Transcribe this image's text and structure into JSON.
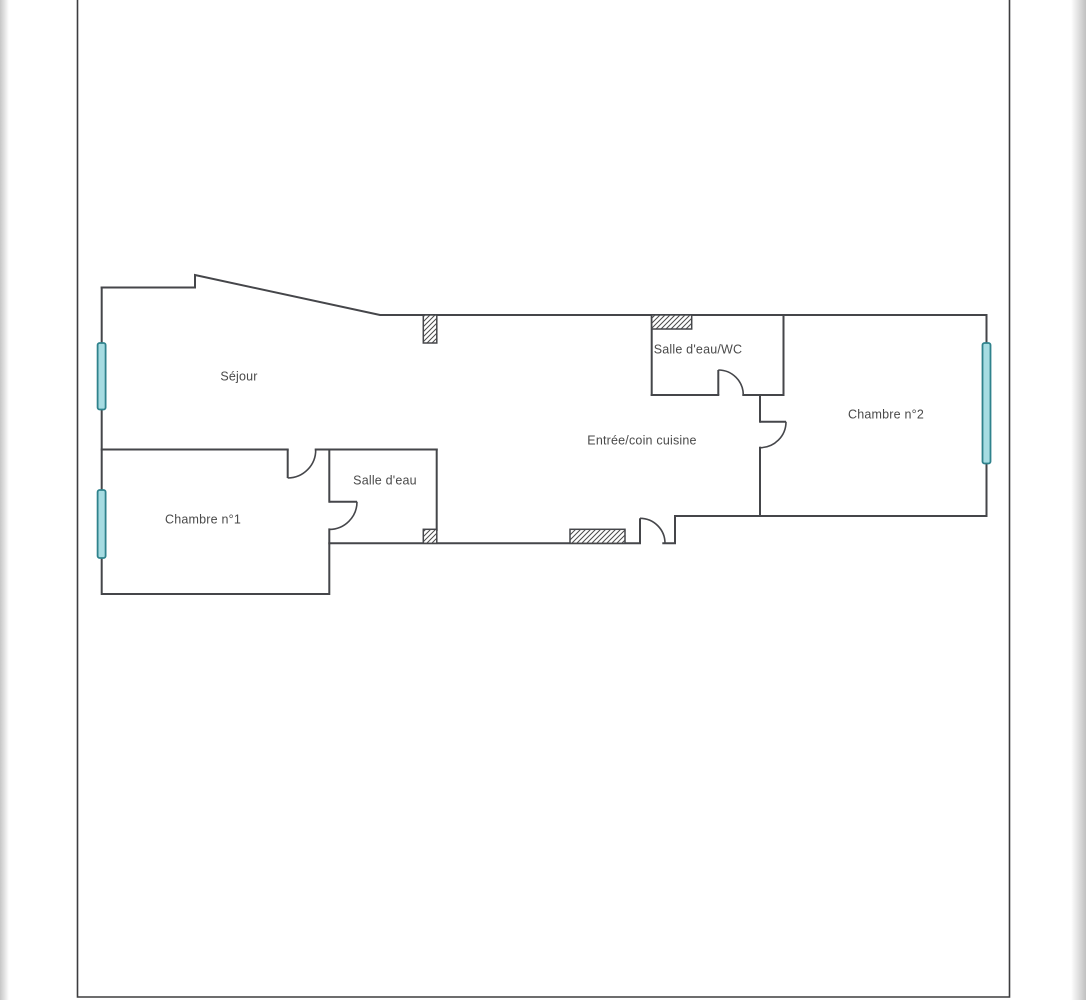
{
  "document_kind": "apartment-floor-plan",
  "colors": {
    "wall": "#45464a",
    "page_border": "#3d3d3f",
    "text": "#4a4a4a",
    "window_fill": "#a6dce2",
    "window_stroke": "#2f828c",
    "hatch_line": "#4a4a4a",
    "page_background": "#ffffff"
  },
  "rooms": [
    {
      "name": "sejour",
      "label": "Séjour",
      "x": 239,
      "y": 377
    },
    {
      "name": "chambre-1",
      "label": "Chambre n°1",
      "x": 203,
      "y": 520
    },
    {
      "name": "salle-deau",
      "label": "Salle d'eau",
      "x": 385,
      "y": 481
    },
    {
      "name": "entree-cuisine",
      "label": "Entrée/coin cuisine",
      "x": 642,
      "y": 441
    },
    {
      "name": "salle-deau-wc",
      "label": "Salle d'eau/WC",
      "x": 698,
      "y": 350
    },
    {
      "name": "chambre-2",
      "label": "Chambre n°2",
      "x": 886,
      "y": 415
    }
  ],
  "plan": {
    "page_border": {
      "points": [
        [
          77.5,
          0
        ],
        [
          77.5,
          997
        ],
        [
          1009.5,
          997
        ],
        [
          1009.5,
          0
        ]
      ]
    },
    "walls": [
      {
        "name": "perimeter-top-right",
        "points": [
          [
            101.7,
            287.5
          ],
          [
            195,
            287.5
          ],
          [
            195,
            275
          ],
          [
            380,
            315
          ],
          [
            986.5,
            315
          ],
          [
            986.5,
            516
          ],
          [
            675,
            516
          ],
          [
            675,
            543.3
          ],
          [
            663.3,
            543.3
          ]
        ]
      },
      {
        "name": "perimeter-bottom-left",
        "points": [
          [
            640,
            543.3
          ],
          [
            329.3,
            543.3
          ],
          [
            329.3,
            594
          ],
          [
            101.7,
            594
          ],
          [
            101.7,
            287.5
          ]
        ]
      },
      {
        "name": "sejour-chambre1-divider",
        "points": [
          [
            101.7,
            449.5
          ],
          [
            287.7,
            449.5
          ]
        ]
      },
      {
        "name": "sejour-divider-right",
        "points": [
          [
            315.7,
            449.5
          ],
          [
            436.7,
            449.5
          ]
        ]
      },
      {
        "name": "salle-deau-left-upper",
        "points": [
          [
            329.3,
            449.5
          ],
          [
            329.3,
            501.7
          ]
        ]
      },
      {
        "name": "salle-deau-left-lower",
        "points": [
          [
            329.3,
            529.4
          ],
          [
            329.3,
            543.3
          ]
        ]
      },
      {
        "name": "salle-deau-right",
        "points": [
          [
            436.7,
            449.5
          ],
          [
            436.7,
            530
          ]
        ]
      },
      {
        "name": "wc-left",
        "points": [
          [
            651.7,
            315
          ],
          [
            651.7,
            395
          ]
        ]
      },
      {
        "name": "wc-bottom-left",
        "points": [
          [
            651.7,
            395
          ],
          [
            718.3,
            395
          ]
        ]
      },
      {
        "name": "wc-bottom-right",
        "points": [
          [
            743.3,
            395
          ],
          [
            783.5,
            395
          ]
        ]
      },
      {
        "name": "wc-right",
        "points": [
          [
            783.5,
            315
          ],
          [
            783.5,
            395
          ]
        ]
      },
      {
        "name": "chambre2-divider-upper",
        "points": [
          [
            760,
            395
          ],
          [
            760,
            421.7
          ]
        ]
      },
      {
        "name": "chambre2-divider-lower",
        "points": [
          [
            760,
            447.7
          ],
          [
            760,
            516
          ]
        ]
      }
    ],
    "doors": [
      {
        "name": "sejour-to-chambre1",
        "leaf": [
          [
            287.7,
            449.5
          ],
          [
            287.7,
            478
          ]
        ],
        "arc": {
          "from": [
            287.7,
            478
          ],
          "to": [
            315.7,
            449.5
          ],
          "r": 28,
          "sweep": 0
        }
      },
      {
        "name": "salle-deau",
        "leaf": [
          [
            329.3,
            501.7
          ],
          [
            357,
            501.7
          ]
        ],
        "arc": {
          "from": [
            357,
            501.7
          ],
          "to": [
            329.3,
            529.4
          ],
          "r": 27.7,
          "sweep": 1
        }
      },
      {
        "name": "salle-deau-wc",
        "leaf": [
          [
            718.3,
            395
          ],
          [
            718.3,
            370
          ]
        ],
        "arc": {
          "from": [
            718.3,
            370
          ],
          "to": [
            743.3,
            395
          ],
          "r": 25,
          "sweep": 1
        }
      },
      {
        "name": "chambre2",
        "leaf": [
          [
            760,
            421.7
          ],
          [
            786,
            421.7
          ]
        ],
        "arc": {
          "from": [
            786,
            421.7
          ],
          "to": [
            760,
            447.7
          ],
          "r": 26,
          "sweep": 1
        }
      },
      {
        "name": "entree-entrance",
        "leaf": [
          [
            640,
            543.3
          ],
          [
            640,
            518.3
          ]
        ],
        "arc": {
          "from": [
            640,
            518.3
          ],
          "to": [
            665,
            543.3
          ],
          "r": 25,
          "sweep": 1
        }
      }
    ],
    "windows": [
      {
        "name": "sejour",
        "x": 97.6,
        "y": 343,
        "w": 8,
        "h": 66.5
      },
      {
        "name": "chambre1",
        "x": 97.6,
        "y": 490,
        "w": 8,
        "h": 68
      },
      {
        "name": "chambre2",
        "x": 982.5,
        "y": 343,
        "w": 8,
        "h": 120.5
      }
    ],
    "vents": [
      {
        "name": "entree-top",
        "x": 423.3,
        "y": 315,
        "w": 13.5,
        "h": 28
      },
      {
        "name": "wc-top",
        "x": 651.7,
        "y": 315,
        "w": 40,
        "h": 14
      },
      {
        "name": "entree-bottom",
        "x": 570,
        "y": 529.3,
        "w": 55,
        "h": 14
      },
      {
        "name": "salle-deau-corner",
        "x": 423.3,
        "y": 529.3,
        "w": 13.5,
        "h": 14
      }
    ]
  }
}
